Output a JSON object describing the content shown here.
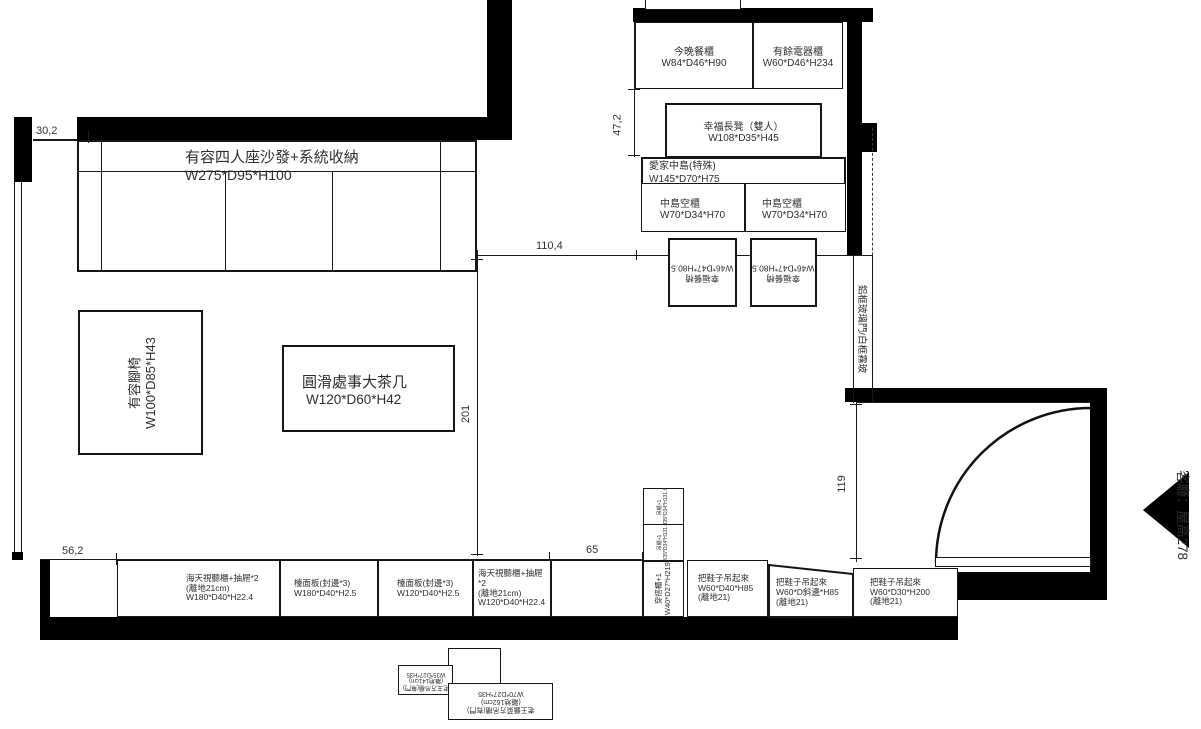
{
  "colors": {
    "wall": "#000000",
    "line": "#1a1a1a",
    "text": "#2f2f2f",
    "background": "#ffffff"
  },
  "dims": {
    "top_left": "30,2",
    "kitchen_gap": "47,2",
    "opening": "110,4",
    "living_depth": "201",
    "left_bottom": "56,2",
    "column_width": "65",
    "entry_depth": "119"
  },
  "annotations": {
    "glass_door": "鋁框玻璃門/白框霧玻",
    "room_note": "客廳：屋高278"
  },
  "furniture": {
    "sofa": {
      "name": "有容四人座沙發+系統收納",
      "dims": "W275*D95*H100"
    },
    "ottoman": {
      "name": "有容腳椅",
      "dims": "W100*D85*H43"
    },
    "coffee_table": {
      "name": "圓滑處事大茶几",
      "dims": "W120*D60*H42"
    },
    "dining_cabinet": {
      "name": "今晚餐櫃",
      "dims": "W84*D46*H90"
    },
    "appliance_cabinet": {
      "name": "有餘電器櫃",
      "dims": "W60*D46*H234"
    },
    "bench": {
      "name": "幸福長凳（雙人）",
      "dims": "W108*D35*H45"
    },
    "island": {
      "name": "愛家中島(特殊)",
      "dims": "W145*D70*H75"
    },
    "island_cabinet_left": {
      "name": "中島空櫃",
      "dims": "W70*D34*H70"
    },
    "island_cabinet_right": {
      "name": "中島空櫃",
      "dims": "W70*D34*H70"
    },
    "chair_left": {
      "name": "幸福餐椅",
      "dims": "W46*D47*H80.5"
    },
    "chair_right": {
      "name": "幸福餐椅",
      "dims": "W46*D47*H80.5"
    },
    "tv_cabinet_w180": {
      "name": "海天視聽櫃+抽屜*2",
      "sub": "(離地21cm)",
      "dims": "W180*D40*H22.4"
    },
    "counter_w180": {
      "name": "檯面板(封邊*3)",
      "dims": "W180*D40*H2.5"
    },
    "counter_w120": {
      "name": "檯面板(封邊*3)",
      "dims": "W120*D40*H2.5"
    },
    "tv_cabinet_w120": {
      "name": "海天視聽櫃+抽屜*2",
      "sub": "(離地21cm)",
      "dims": "W120*D40*H22.4"
    },
    "upper_box_top": {
      "name": "吊櫃+1",
      "dims": "W35*D34*H131.6"
    },
    "upper_box_bottom": {
      "name": "吊櫃+1",
      "dims": "W35*D34*H131.6"
    },
    "wardrobe": {
      "name": "穿搭櫃+1",
      "dims": "W40*D27*H219"
    },
    "shoe_cabinet_1": {
      "name": "把鞋子吊起來",
      "dims": "W60*D40*H85",
      "sub": "(離地21)"
    },
    "shoe_cabinet_2": {
      "name": "把鞋子吊起來",
      "dims": "W60*D斜邊*H85",
      "sub": "(離地21)"
    },
    "shoe_cabinet_3": {
      "name": "把鞋子吊起來",
      "dims": "W60*D30*H200",
      "sub": "(離地21)"
    },
    "hanging_cabinet_small": {
      "name": "老王方吊櫃(無門)",
      "sub": "(離地141cm)",
      "dims": "W35*D27*H35"
    },
    "hanging_cabinet_wide": {
      "name": "老王醬菜方吊櫃(有門)",
      "sub": "(離地162cm)",
      "dims": "W70*D27*H35"
    }
  }
}
